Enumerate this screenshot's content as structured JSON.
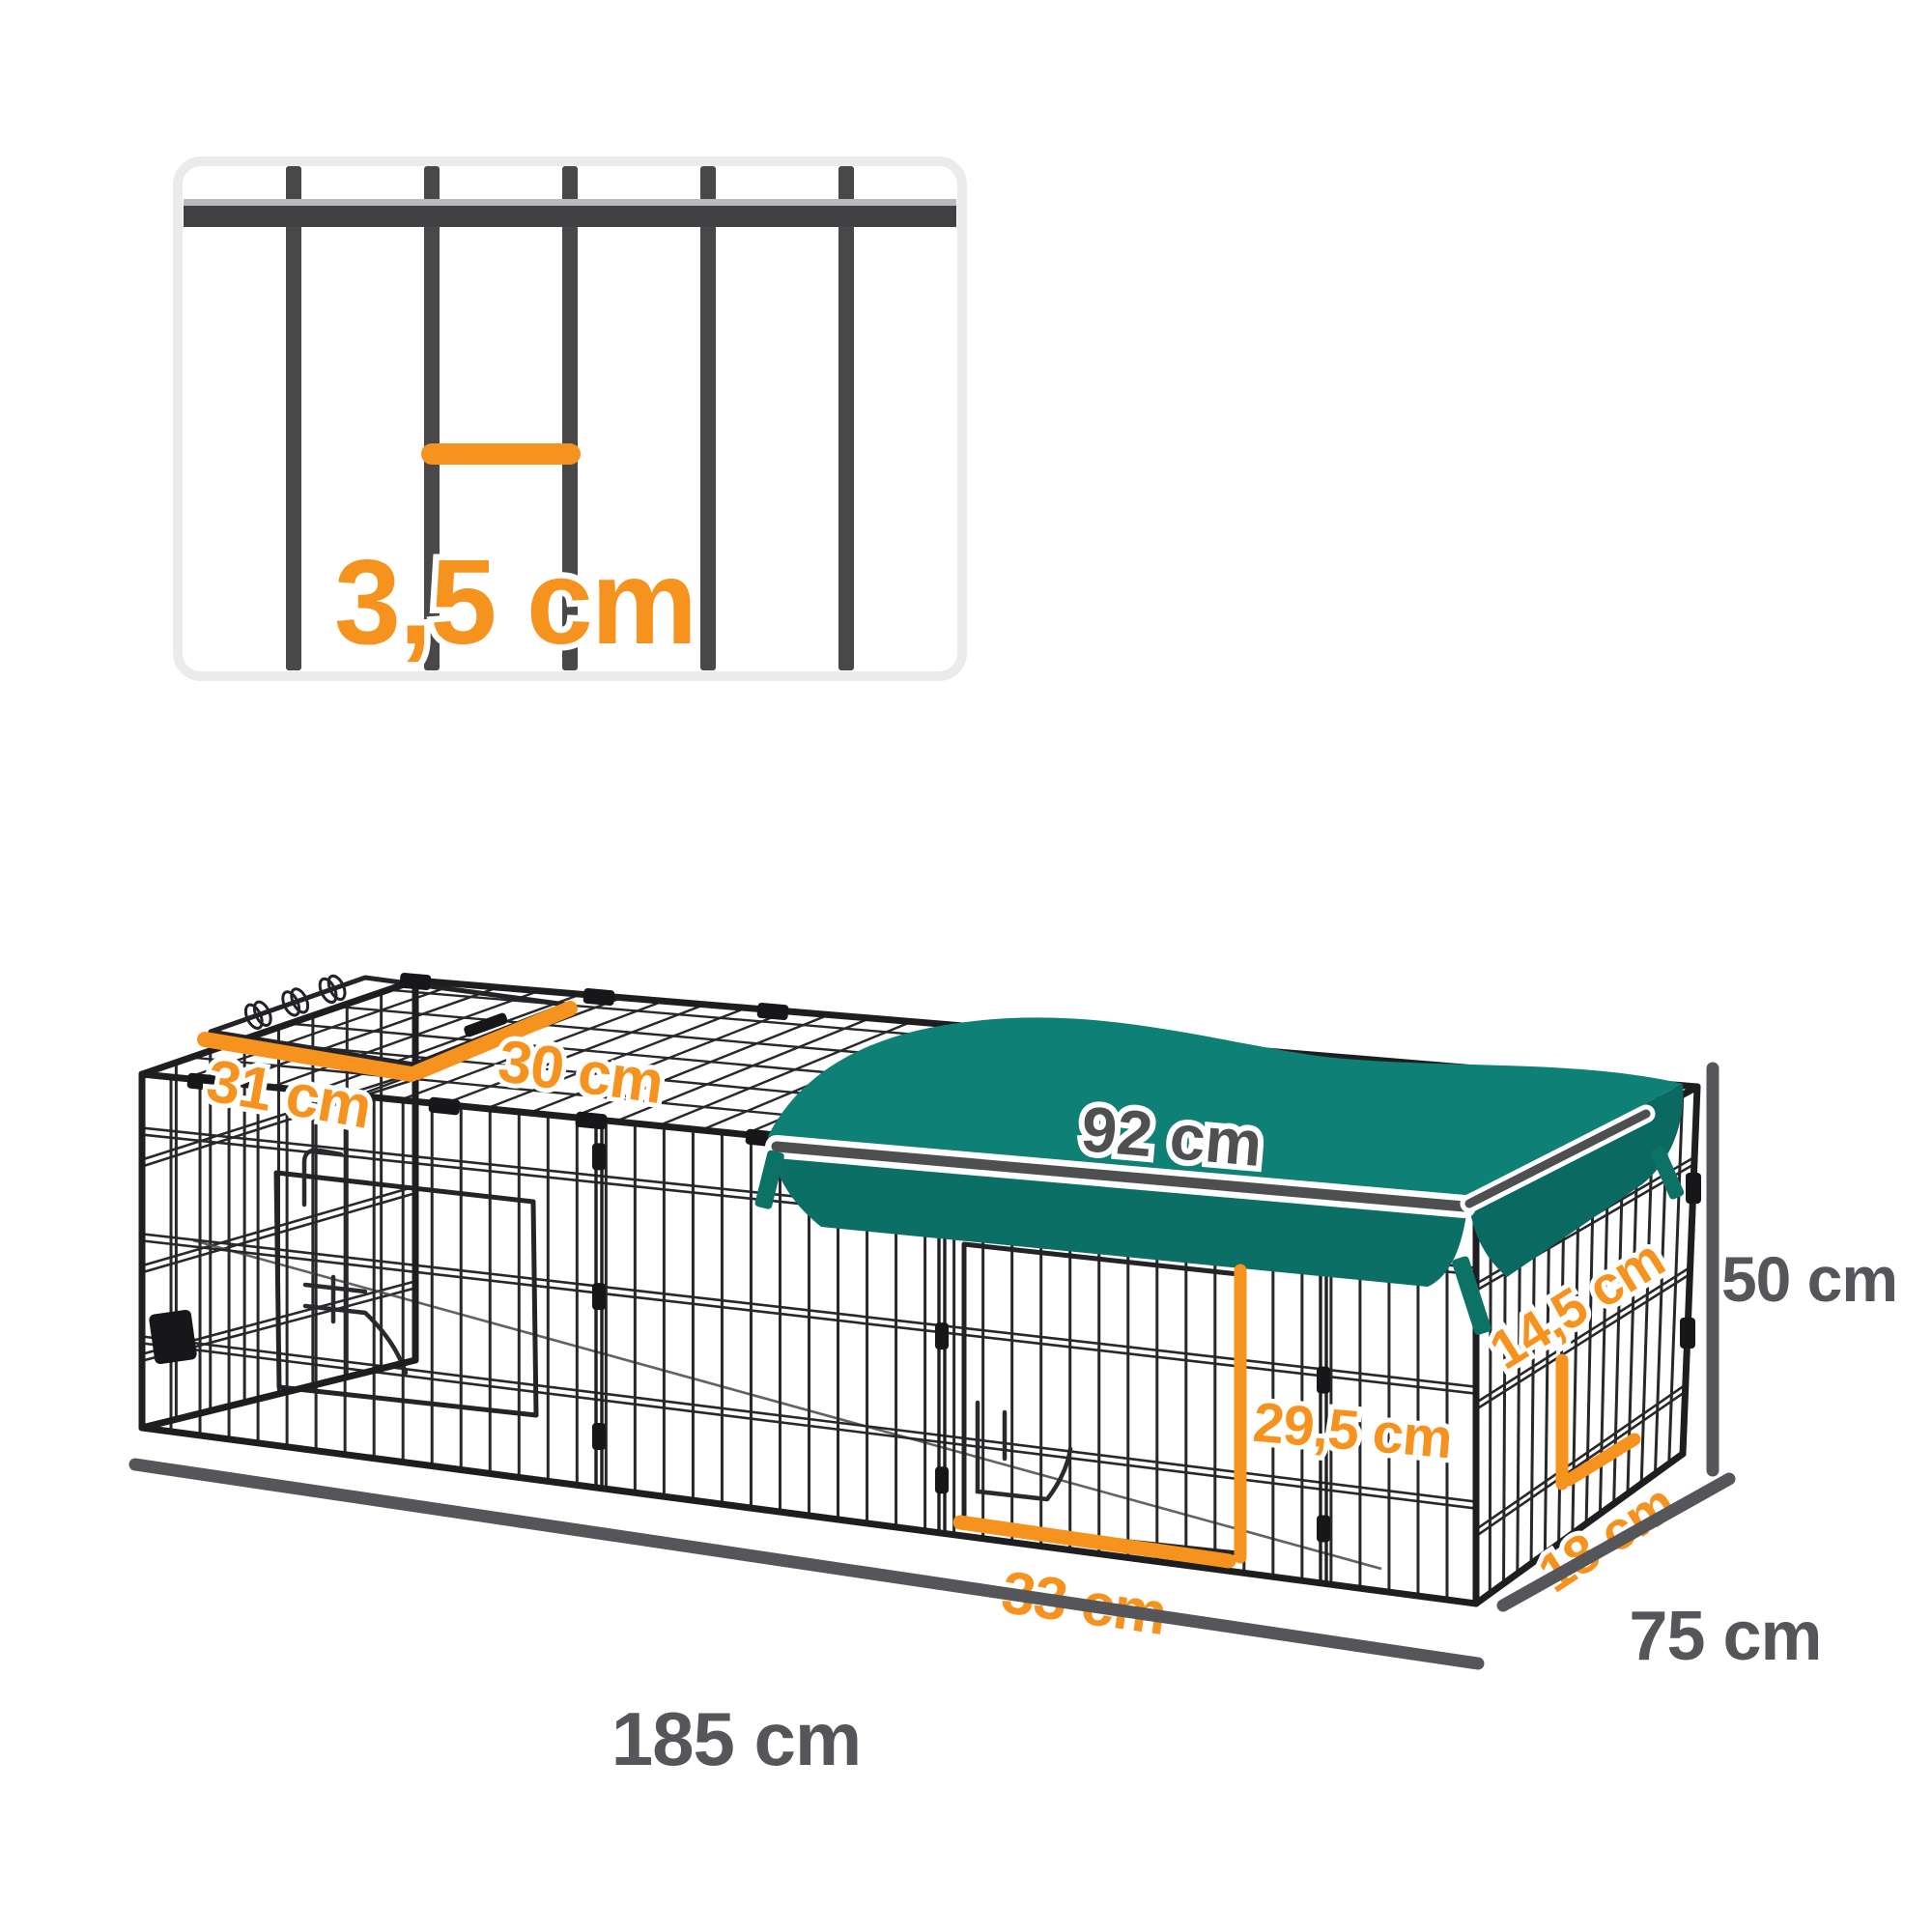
{
  "diagram": {
    "product": "metal pet playpen with cover - dimension diagram",
    "colors": {
      "accent": "#F6921E",
      "dim": "#55565A",
      "cover": "#0E8076",
      "cover_edge": "#0C6F66",
      "cover_drape": "#0A6960",
      "ribbon": "#0B7265",
      "wire": "#28282B",
      "frame": "#1E1E21",
      "inset_border": "#EBEBED",
      "bar": "#48484B"
    },
    "inset": {
      "bar_gap_label": "3,5 cm"
    },
    "dims": {
      "roof_door_side": "31 cm",
      "roof_door_front": "30 cm",
      "cover_length": "92 cm",
      "side_top_gap": "14,5 cm",
      "front_door_height": "29,5 cm",
      "front_door_width": "33 cm",
      "side_bottom_gap": "18 cm",
      "height": "50 cm",
      "length": "185 cm",
      "depth": "75 cm"
    }
  }
}
